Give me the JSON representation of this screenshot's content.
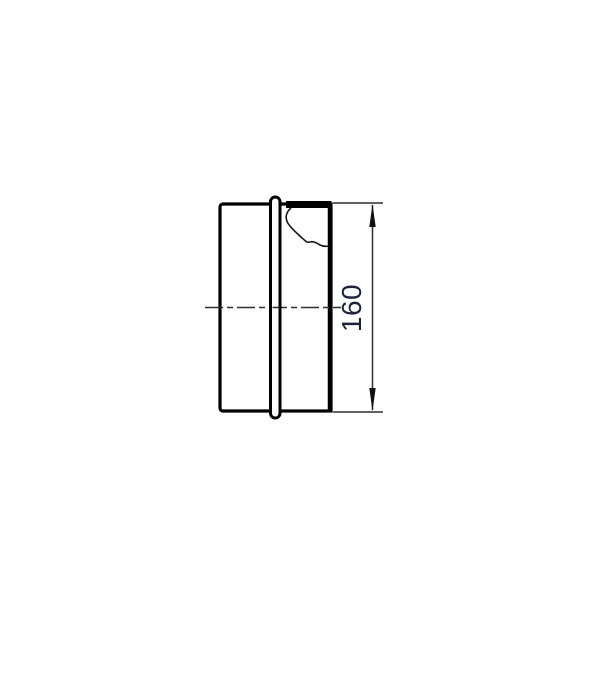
{
  "figure": {
    "dimension_label": {
      "value": "160",
      "color": "#1c2438"
    },
    "colors": {
      "background": "#ffffff",
      "outline": "#000000",
      "thin_line": "#2f2f2f"
    }
  }
}
